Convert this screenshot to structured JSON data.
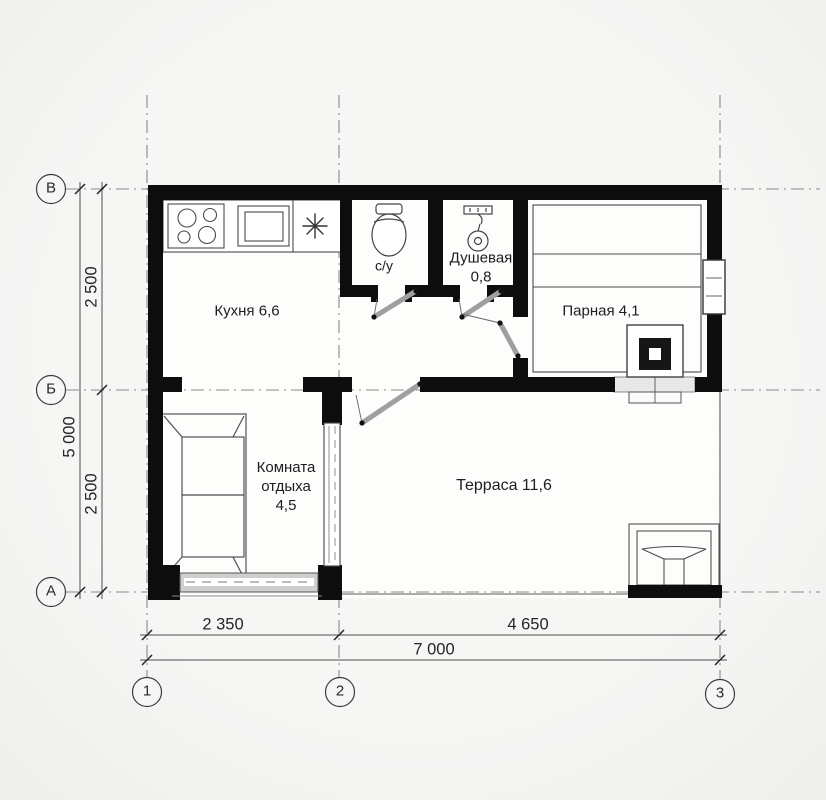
{
  "plan_type": "floor-plan",
  "axis_bubbles": {
    "rows": [
      {
        "label": "В"
      },
      {
        "label": "Б"
      },
      {
        "label": "А"
      }
    ],
    "cols": [
      {
        "label": "1"
      },
      {
        "label": "2"
      },
      {
        "label": "3"
      }
    ]
  },
  "dimensions": {
    "left_segment_top": "2 500",
    "left_total": "5 000",
    "left_segment_bottom": "2 500",
    "bottom_segment_left": "2 350",
    "bottom_segment_right": "4 650",
    "bottom_total": "7 000"
  },
  "rooms": {
    "kitchen": {
      "label": "Кухня 6,6"
    },
    "wc": {
      "label": "с/у"
    },
    "shower": {
      "label": "Душевая",
      "area": "0,8"
    },
    "steam": {
      "label": "Парная 4,1"
    },
    "rest": {
      "line1": "Комната",
      "line2": "отдыха",
      "area": "4,5"
    },
    "terrace": {
      "label": "Терраса 11,6"
    }
  },
  "colors": {
    "wall": "#0d0d0d",
    "thin_line": "#4a4a4a",
    "grid_line": "#8a8a8a",
    "door_leaf": "#9f9f9f",
    "background": "#f4f4f2"
  }
}
